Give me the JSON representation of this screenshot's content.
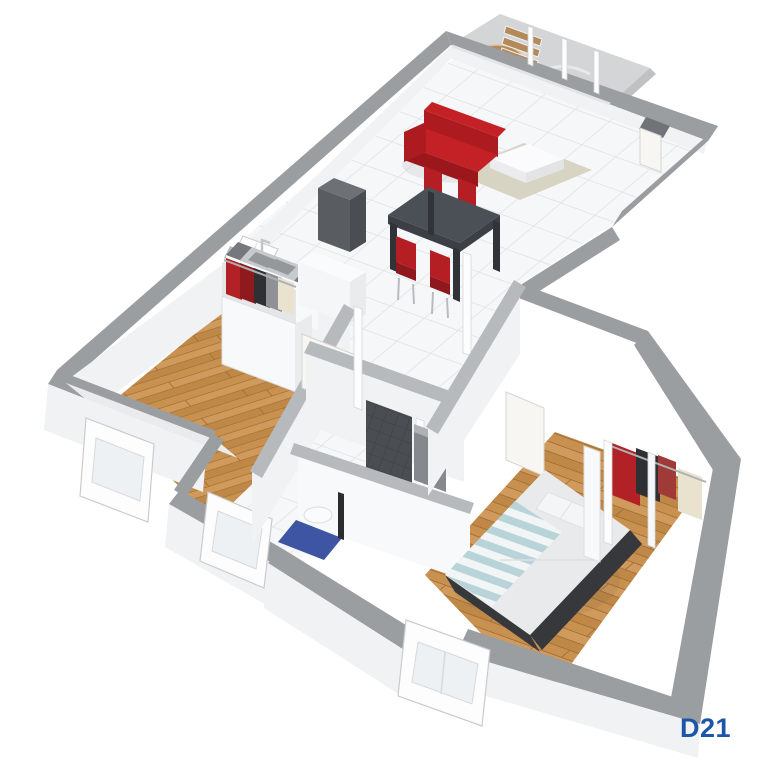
{
  "plan": {
    "label": "D21",
    "kind": "3D isometric apartment floor plan rendering",
    "background": "#ffffff"
  },
  "rooms": [
    {
      "name": "balcony",
      "furniture": [
        "round-wood-table",
        "two-wood-slat-chairs"
      ]
    },
    {
      "name": "living-room",
      "furniture": [
        "red-sofa",
        "white-coffee-table",
        "beige-rug",
        "dark-dining-table",
        "four-red-chairs"
      ]
    },
    {
      "name": "kitchen",
      "furniture": [
        "double-steel-sink",
        "dark-counter",
        "tall-dark-unit",
        "white-appliance"
      ]
    },
    {
      "name": "bedroom-1",
      "furniture": [
        "single-bed-yellow-blanket",
        "open-wardrobe-with-clothes",
        "two-windows"
      ]
    },
    {
      "name": "bathroom",
      "furniture": [
        "dark-tiled-shower",
        "white-basin",
        "blue-bath-mat",
        "towel-bar"
      ]
    },
    {
      "name": "bedroom-2",
      "furniture": [
        "double-bed-striped-blanket",
        "walk-in-wardrobe-with-clothes",
        "bay-window"
      ]
    },
    {
      "name": "hallway",
      "furniture": [
        "open-doors"
      ]
    }
  ],
  "colors": {
    "wall-cap": "#9b9ea1",
    "wall-cap-light": "#b7babd",
    "wall-cap-dark": "#8d9093",
    "wall-face": "#f1f2f4",
    "wall-face-bright": "#f8f9fb",
    "wall-face-shade": "#e9ebed",
    "tile-floor": "#f6f7f8",
    "tile-grout": "#dcdee0",
    "balcony-floor": "#d3d5d7",
    "balcony-edge": "#bfc1c3",
    "rug": "#d8d4c4",
    "sofa-red": "#c42127",
    "sofa-red-mid": "#ad1b21",
    "sofa-red-dark": "#9c171c",
    "table-top": "#4b5056",
    "table-side": "#3c4046",
    "table-leg": "#303438",
    "chair-red": "#b51f24",
    "chair-red-dark": "#8f181c",
    "metal": "#b9bcbe",
    "wood-chair": "#b48a5a",
    "wood-chair-light": "#c29b6a",
    "counter-top": "#75797d",
    "steel": "#c7cacc",
    "steel-dark": "#94989b",
    "unit-front": "#595d62",
    "unit-side": "#4a4e53",
    "unit-top": "#6d7175",
    "appliance": "#f5f6f8",
    "door-leaf": "#f7f6f2",
    "door-frame": "#d5d5d1",
    "shower-dark": "#4a4e53",
    "shower-cell": "#85898d",
    "shower-cell-top": "#aeb2b5",
    "mat-blue": "#3d55a3",
    "bed1-yellow": "#ddb13a",
    "bed-wood": "#c8904e",
    "mattress": "#eef0f1",
    "duvet": "#e9eaeb",
    "stripe-blue": "#b9d4d9",
    "stripe-white": "#f2f5f5",
    "bed2-frame": "#37383c",
    "cloth-red": "#b22126",
    "cloth-dark": "#2f3034",
    "cloth-gray": "#8f9196",
    "cloth-cream": "#e8e2cf",
    "threshold": "#707478",
    "label-blue": "#1d56a8",
    "shadow": "rgba(60,64,68,0.08)"
  }
}
